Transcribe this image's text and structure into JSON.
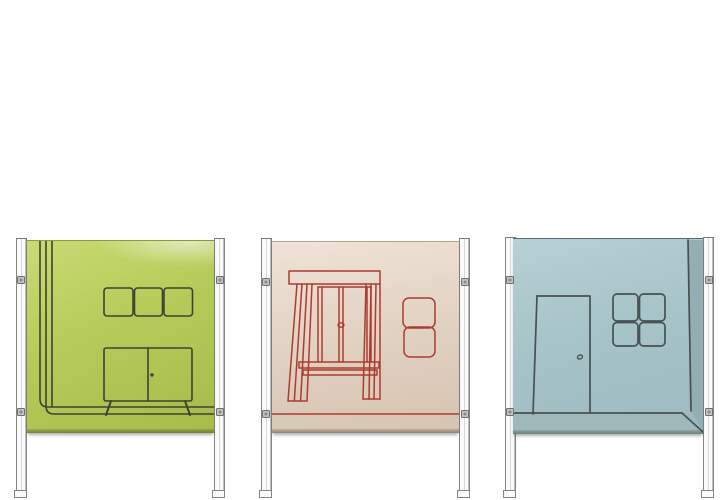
{
  "scene": {
    "title": "Three illustrated room-divider screens on slim metal stands against a white background",
    "background": "#ffffff"
  },
  "screens": [
    {
      "id": "green-screen",
      "panel_color_name": "lime green",
      "motif": "room corner with wall shelf of three compartments and a two-door sideboard on splayed legs",
      "elements": [
        "wall-corner-lines",
        "wall-shelf",
        "sideboard",
        "floor-lines"
      ]
    },
    {
      "id": "cream-screen",
      "panel_color_name": "cream",
      "motif": "window with pelmet, curtains, sill and two stacked picture frames, drawn in red",
      "elements": [
        "pelmet",
        "left-curtain",
        "right-curtain",
        "window",
        "sill",
        "picture-frames",
        "floor-line"
      ]
    },
    {
      "id": "blue-screen",
      "panel_color_name": "dusty blue",
      "motif": "room corner with closed door and four-pane window",
      "elements": [
        "door",
        "door-handle",
        "four-pane-window",
        "corner-line",
        "floor-strip"
      ]
    }
  ],
  "colors": {
    "scene_bg": "#ffffff",
    "green_bg": "#b5cb59",
    "green_bg_light": "#c9da74",
    "green_bg_dark": "#a5bb4a",
    "green_line": "#3e4233",
    "cream_bg": "#e0d0c0",
    "cream_bg_light": "#efe3d7",
    "cream_bg_dark": "#d6c3b1",
    "cream_line": "#ad3b30",
    "blue_bg": "#a7c4c9",
    "blue_bg_light": "#b7d0d5",
    "blue_bg_dark": "#9cb9bf",
    "blue_line": "#475053",
    "blue_floor": "#9fb9ba",
    "blue_corner": "#93afb3",
    "post_edge": "#848484",
    "post_fill": "#fbfbfb",
    "post_inner": "#d8d8d8",
    "bolt_fill": "#c3c3c3",
    "bolt_edge": "#6e6e6e",
    "panel_shadow": "rgba(0,0,0,0.32)"
  }
}
